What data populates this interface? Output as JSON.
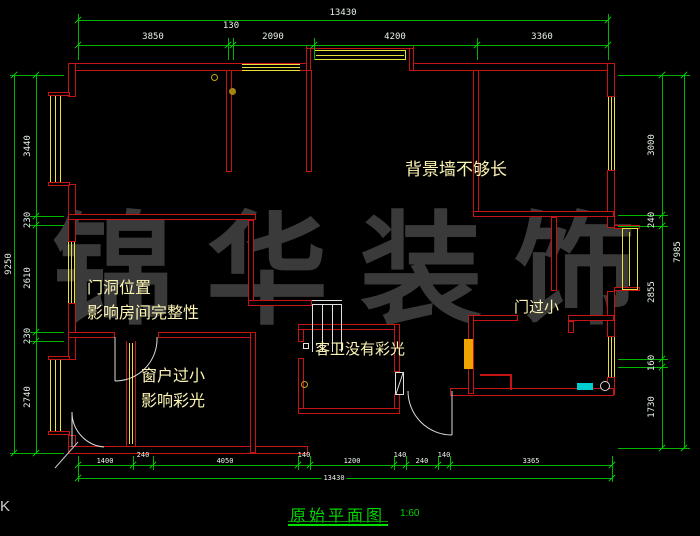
{
  "watermark": "锦华装饰",
  "corner_mark": "K",
  "title": {
    "name": "原始平面图",
    "scale": "1:60"
  },
  "annotations": {
    "bg_wall": "背景墙不够长",
    "door_pos_1": "门洞位置",
    "door_pos_2": "影响房间完整性",
    "window_1": "窗户过小",
    "window_2": "影响彩光",
    "bath": "客卫没有彩光",
    "door_small": "门过小"
  },
  "dimensions": {
    "top": {
      "total": "13430",
      "segments": [
        "3850",
        "130",
        "2090",
        "4200",
        "3360"
      ]
    },
    "left": {
      "total": "9250",
      "segments": [
        "3440",
        "230",
        "2610",
        "230",
        "2740"
      ]
    },
    "right": {
      "total": "7985",
      "segments": [
        "3000",
        "240",
        "2855",
        "160",
        "1730"
      ]
    },
    "bottom": {
      "total": "13430",
      "segments": [
        "1400",
        "240",
        "4050",
        "140",
        "1200",
        "140",
        "240",
        "140",
        "3365"
      ]
    }
  },
  "colors": {
    "wall": "#c41414",
    "window": "#e8e23a",
    "dimension": "#00c800",
    "annotation": "#fcf5b4",
    "title": "#00d400",
    "watermark": "#3a3a3a"
  }
}
